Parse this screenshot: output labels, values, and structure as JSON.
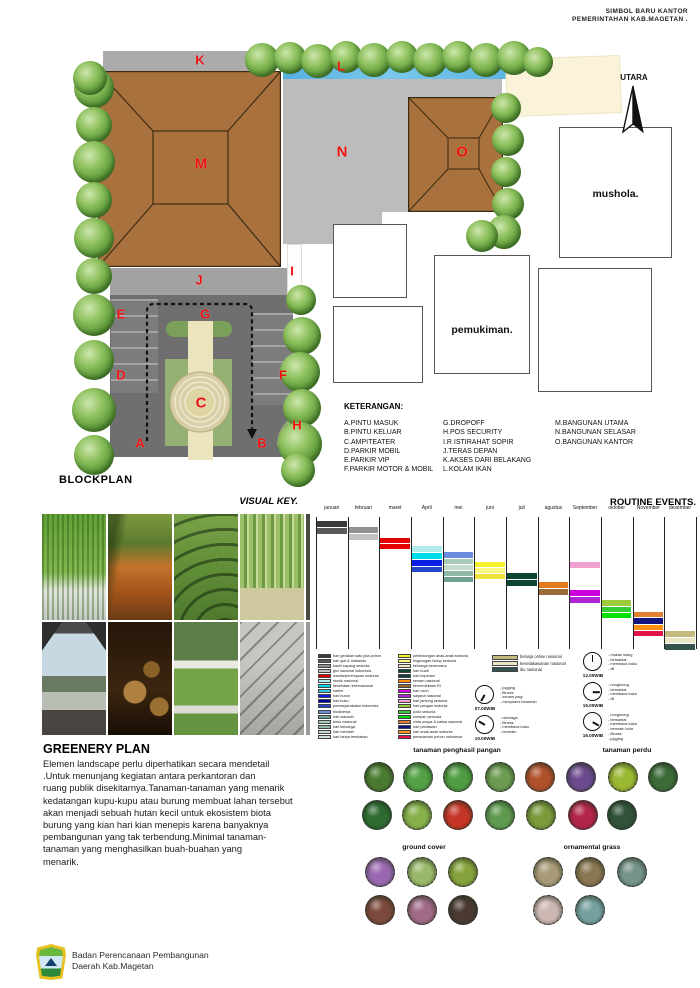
{
  "header": {
    "line1": "SIMBOL BARU KANTOR",
    "line2": "PEMERINTAHAN KAB.MAGETAN ."
  },
  "compass": {
    "label": "UTARA"
  },
  "plan": {
    "letters": [
      "K",
      "L",
      "M",
      "N",
      "O",
      "J",
      "I",
      "E",
      "G",
      "D",
      "F",
      "C",
      "A",
      "B",
      "H"
    ],
    "mushola": "mushola.",
    "pemukiman": "pemukiman."
  },
  "blockplan_title": "BLOCKPLAN",
  "keterangan": {
    "title": "KETERANGAN:",
    "col1": [
      "A.PINTU MASUK",
      "B.PINTU KELUAR",
      "C.AMPITEATER",
      "D.PARKIR MOBIL",
      "E.PARKIR VIP",
      "F.PARKIR MOTOR & MOBIL"
    ],
    "col2": [
      "G.DROPOFF",
      "H.POS SECURITY",
      "I.R ISTIRAHAT SOPIR",
      "J.TERAS DEPAN",
      "K.AKSES DARI BELAKANG",
      "L.KOLAM IKAN"
    ],
    "col3": [
      "M.BANGUNAN UTAMA",
      "N.BANGUNAN SELASAR",
      "O.BANGUNAN KANTOR"
    ]
  },
  "visual_key": {
    "title": "VISUAL KEY.",
    "photos": [
      "green-wall",
      "forest-boardwalk",
      "grass-amphitheater",
      "bamboo-path",
      "garden-pavilion",
      "log-bollards",
      "curved-bench",
      "concrete-stairs"
    ]
  },
  "chart_data": {
    "type": "heatmap",
    "title": "ROUTINE EVENTS.",
    "categories": [
      "januari",
      "februari",
      "maret",
      "April",
      "mei",
      "juni",
      "juli",
      "agustus",
      "September",
      "oktober",
      "November",
      "desember"
    ],
    "bars": [
      {
        "m": 0,
        "o": 2,
        "h": 6,
        "c": "#3a3a3a"
      },
      {
        "m": 0,
        "o": 9,
        "h": 6,
        "c": "#5a5a5a"
      },
      {
        "m": 1,
        "o": 8,
        "h": 6,
        "c": "#919191"
      },
      {
        "m": 1,
        "o": 15,
        "h": 6,
        "c": "#c2c2c2"
      },
      {
        "m": 2,
        "o": 19,
        "h": 5,
        "c": "#e60000"
      },
      {
        "m": 2,
        "o": 25,
        "h": 5,
        "c": "#e60000"
      },
      {
        "m": 3,
        "o": 27,
        "h": 6,
        "c": "#b0ecec"
      },
      {
        "m": 3,
        "o": 34,
        "h": 6,
        "c": "#00dcec"
      },
      {
        "m": 3,
        "o": 41,
        "h": 6,
        "c": "#0a1ee6"
      },
      {
        "m": 3,
        "o": 48,
        "h": 5,
        "c": "#2446c8"
      },
      {
        "m": 4,
        "o": 33,
        "h": 6,
        "c": "#6a8ce0"
      },
      {
        "m": 4,
        "o": 40,
        "h": 5,
        "c": "#a6ccb8"
      },
      {
        "m": 4,
        "o": 46,
        "h": 5,
        "c": "#c2dccc"
      },
      {
        "m": 4,
        "o": 52,
        "h": 5,
        "c": "#8fb8a6"
      },
      {
        "m": 4,
        "o": 58,
        "h": 5,
        "c": "#6fa092"
      },
      {
        "m": 5,
        "o": 43,
        "h": 5,
        "c": "#f6f02a"
      },
      {
        "m": 5,
        "o": 49,
        "h": 5,
        "c": "#fbf780"
      },
      {
        "m": 5,
        "o": 55,
        "h": 5,
        "c": "#efe23a"
      },
      {
        "m": 6,
        "o": 54,
        "h": 6,
        "c": "#0c4631"
      },
      {
        "m": 6,
        "o": 61,
        "h": 6,
        "c": "#0c4631"
      },
      {
        "m": 7,
        "o": 63,
        "h": 6,
        "c": "#e4791c"
      },
      {
        "m": 7,
        "o": 70,
        "h": 6,
        "c": "#9a6a3a"
      },
      {
        "m": 8,
        "o": 43,
        "h": 6,
        "c": "#f0a0d0"
      },
      {
        "m": 8,
        "o": 71,
        "h": 6,
        "c": "#cc00dd"
      },
      {
        "m": 8,
        "o": 78,
        "h": 6,
        "c": "#b024d8"
      },
      {
        "m": 9,
        "o": 81,
        "h": 6,
        "c": "#9ecb3b"
      },
      {
        "m": 9,
        "o": 88,
        "h": 5,
        "c": "#35cc35"
      },
      {
        "m": 9,
        "o": 94,
        "h": 5,
        "c": "#00e000"
      },
      {
        "m": 10,
        "o": 93,
        "h": 5,
        "c": "#e08030"
      },
      {
        "m": 10,
        "o": 99,
        "h": 6,
        "c": "#131380"
      },
      {
        "m": 10,
        "o": 106,
        "h": 5,
        "c": "#ff9010"
      },
      {
        "m": 10,
        "o": 112,
        "h": 5,
        "c": "#e41448"
      },
      {
        "m": 11,
        "o": 112,
        "h": 6,
        "c": "#c4b97e"
      },
      {
        "m": 11,
        "o": 119,
        "h": 5,
        "c": "#e9e6c8"
      },
      {
        "m": 11,
        "o": 125,
        "h": 6,
        "c": "#33514d"
      }
    ]
  },
  "legend1": [
    {
      "color": "#3a3a3a",
      "label": "hari gerakan satu juta pohon"
    },
    {
      "color": "#5a5a5a",
      "label": "hari gizi & makanan"
    },
    {
      "color": "#919191",
      "label": "kasih sayang sedunia"
    },
    {
      "color": "#c2c2c2",
      "label": "gizi nasional indonesia"
    },
    {
      "color": "#e60000",
      "label": "wanita/perempuan sedunia"
    },
    {
      "color": "#b0ecec",
      "label": "musik nasional"
    },
    {
      "color": "#00dcec",
      "label": "kesehatan internasional"
    },
    {
      "color": "#34c6dc",
      "label": "kartini"
    },
    {
      "color": "#0a1ee6",
      "label": "hari buruh"
    },
    {
      "color": "#0000a0",
      "label": "hari buku"
    },
    {
      "color": "#2446c8",
      "label": "pemasyarakatan indonesia"
    },
    {
      "color": "#6a8ce0",
      "label": "biodiversa"
    },
    {
      "color": "#6fa092",
      "label": "hari wanadri"
    },
    {
      "color": "#a6ccb8",
      "label": "buku nasional"
    },
    {
      "color": "#8fb8a6",
      "label": "hari keluarga"
    },
    {
      "color": "#c2dccc",
      "label": "hari member"
    },
    {
      "color": "#cfe0d8",
      "label": "hari tanpa tembakau"
    }
  ],
  "legend2": [
    {
      "color": "#f6f02a",
      "label": "perlindungan anak-anak sedunia"
    },
    {
      "color": "#fbf780",
      "label": "lingkungan hidup sedunia"
    },
    {
      "color": "#efe8c0",
      "label": "keluarga berencana"
    },
    {
      "color": "#0c4631",
      "label": "hari buah"
    },
    {
      "color": "#123c3c",
      "label": "hari koperasi"
    },
    {
      "color": "#ff8c00",
      "label": "senam nasional"
    },
    {
      "color": "#9a6a3a",
      "label": "kemerdekaan RI"
    },
    {
      "color": "#cc00dd",
      "label": "hari ozon"
    },
    {
      "color": "#b024d8",
      "label": "sarjana nasional"
    },
    {
      "color": "#f0a0d0",
      "label": "hari jantung sedunia"
    },
    {
      "color": "#9ecb3b",
      "label": "hari pangan sedunia"
    },
    {
      "color": "#35cc35",
      "label": "polio sedunia"
    },
    {
      "color": "#00e000",
      "label": "sumpah pemuda"
    },
    {
      "color": "#e08030",
      "label": "cinta puspa & satwa nasional"
    },
    {
      "color": "#131380",
      "label": "hari pahlawan"
    },
    {
      "color": "#ff9010",
      "label": "hari anak-anak sedunia"
    },
    {
      "color": "#e41448",
      "label": "penanaman pohon indonesia"
    }
  ],
  "legend3": [
    {
      "color": "#c4b97e",
      "label": "belanja online nasional"
    },
    {
      "color": "#e9e6c8",
      "label": "kesetiakawanan nasional"
    },
    {
      "color": "#33514d",
      "label": "ibu nasional"
    }
  ],
  "clocks": [
    {
      "time": "07.00WIB",
      "angle": 210,
      "activities": [
        "- jogging",
        "- fitness",
        "- senam pagi",
        "- menyirami tanaman"
      ]
    },
    {
      "time": "10.00WIB",
      "angle": 300,
      "activities": [
        "- olahraga",
        "- fitness",
        "- membaca buku",
        "- bermain"
      ]
    },
    {
      "time": "12.00WIB",
      "angle": 0,
      "activities": [
        "- makan siang",
        "- bersantai",
        "- membaca buku",
        "- dll"
      ]
    },
    {
      "time": "15.00WIB",
      "angle": 90,
      "activities": [
        "- nongkrong",
        "- bersantai",
        "- membaca buku",
        "- dll"
      ]
    },
    {
      "time": "16.00WIB",
      "angle": 120,
      "activities": [
        "- nongkrong",
        "- bersantai",
        "- membaca buku",
        "- bermain bola",
        "- fitness",
        "- jogging"
      ]
    }
  ],
  "greenery": {
    "title": "GREENERY PLAN",
    "text": "Elemen landscape perlu diperhatikan secara mendetail\n.Untuk menunjang kegiatan antara perkantoran dan\nruang publik disekitarnya.Tanaman-tanaman yang menarik\nkedatangan kupu-kupu atau burung membuat lahan tersebut\nakan menjadi sebuah hutan kecil untuk ekosistem biota\nburung yang kian hari kian menepis karena banyaknya\npembangunan yang tak terbendung.Minimal tanaman-\ntanaman yang menghasilkan buah-buahan yang\nmenarik."
  },
  "plants": {
    "groups": [
      {
        "title": "tanaman penghasil pangan",
        "rows": [
          [
            "#4a7a30",
            "#53a045",
            "#4f9c42",
            "#6b9a50",
            "#b0502a"
          ],
          [
            "#2e6b32",
            "#86b04a",
            "#c43525",
            "#5f9a50",
            "#7c9a3c"
          ]
        ]
      },
      {
        "title": "tanaman perdu",
        "rows": [
          [
            "#6b4a8e",
            "#9ab832",
            "#3c6b38"
          ],
          [
            "#b2254a",
            "#31533a"
          ]
        ]
      },
      {
        "title": "ground cover",
        "rows": [
          [
            "#9a68b0",
            "#9ab86a",
            "#86a23c"
          ],
          [
            "#7c4a3c",
            "#a06a86",
            "#4a3a32"
          ]
        ]
      },
      {
        "title": "ornamental grass",
        "rows": [
          [
            "#a89a78",
            "#8a7652",
            "#76948a"
          ],
          [
            "#cbb6b2",
            "#76a0a0"
          ]
        ]
      }
    ]
  },
  "footer": {
    "org_line1": "Badan Perencanaan Pembangunan",
    "org_line2": "Daerah Kab.Magetan"
  }
}
